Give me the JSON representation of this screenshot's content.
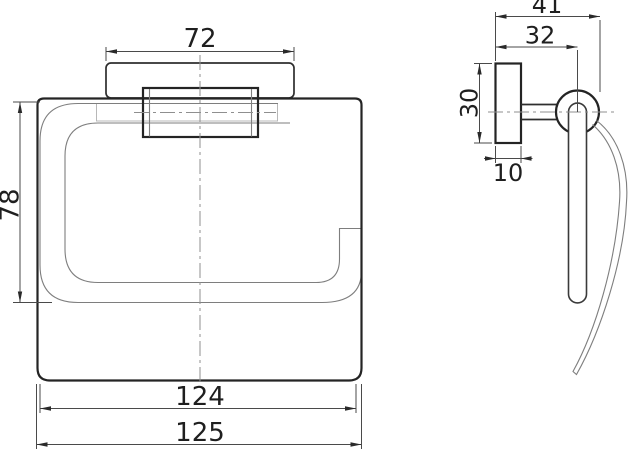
{
  "drawing": {
    "kind": "technical-dimension-drawing",
    "views": {
      "front": {
        "dim_plate_width": "72",
        "dim_opening_height": "78",
        "dim_body_width_inner": "124",
        "dim_body_width_overall": "125"
      },
      "side": {
        "dim_depth_overall": "41",
        "dim_ring_center_offset": "32",
        "dim_plate_height": "30",
        "dim_plate_thickness": "10"
      }
    },
    "colors": {
      "line_main": "#242424",
      "line_thin": "#7e7e7e",
      "line_dim": "#4a4a4a",
      "line_hidden": "#b8b8b8",
      "line_center": "#8f8f8f",
      "background": "#ffffff"
    }
  }
}
